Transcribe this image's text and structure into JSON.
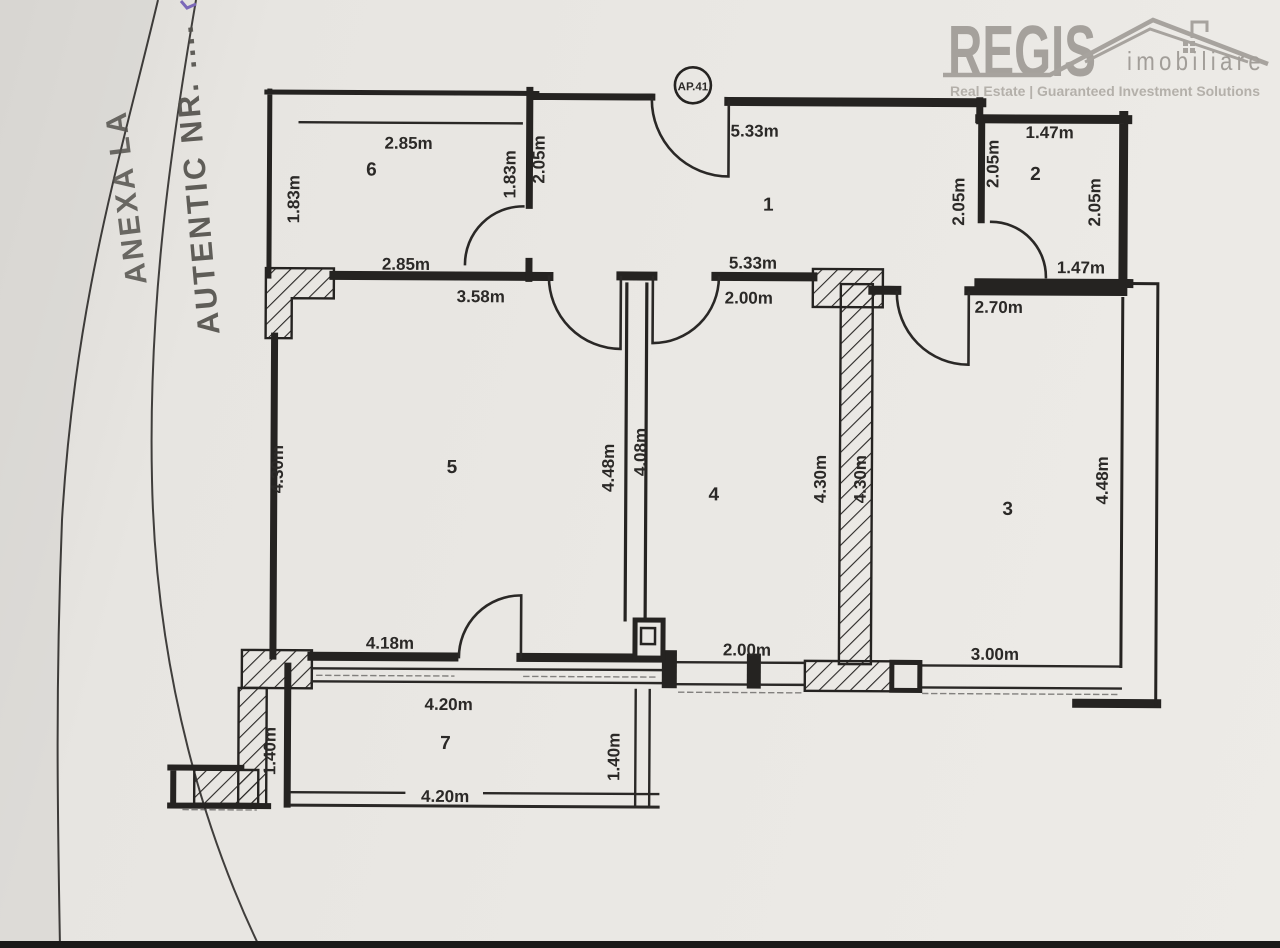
{
  "logo": {
    "brand": "REGIS",
    "brand_sub": "imobiliare",
    "tagline": "Real Estate | Guaranteed Investment Solutions",
    "color": "#a5a19c"
  },
  "stamp": {
    "line1": "ANEXA LA",
    "line2": "AUTENTIC NR. ...."
  },
  "plan": {
    "unit_label": "AP.41",
    "ink_color": "#262422",
    "paper_color": "#e9e7e3",
    "room_numbers": {
      "r1": "1",
      "r2": "2",
      "r3": "3",
      "r4": "4",
      "r5": "5",
      "r6": "6",
      "r7": "7"
    },
    "dims": {
      "room6_top": "2.85m",
      "room6_bottom": "2.85m",
      "room6_left": "1.83m",
      "room6_right": "1.83m",
      "room1_top": "5.33m",
      "room1_bottom": "5.33m",
      "room1_left": "2.05m",
      "room1_right": "2.05m",
      "room2_top": "1.47m",
      "room2_bottom": "1.47m",
      "room2_left": "2.05m",
      "room2_right": "2.05m",
      "hall_top": "2.00m",
      "room5_top": "3.58m",
      "room5_bottom": "4.18m",
      "room5_left": "4.30m",
      "room5_right": "4.48m",
      "room4_left": "4.08m",
      "room4_right": "4.30m",
      "room4_bottom": "2.00m",
      "room3_top": "2.70m",
      "room3_left": "4.30m",
      "room3_right": "4.48m",
      "room3_bottom": "3.00m",
      "room7_top": "4.20m",
      "room7_bottom": "4.20m",
      "room7_left": "1.40m",
      "room7_right": "1.40m"
    }
  }
}
